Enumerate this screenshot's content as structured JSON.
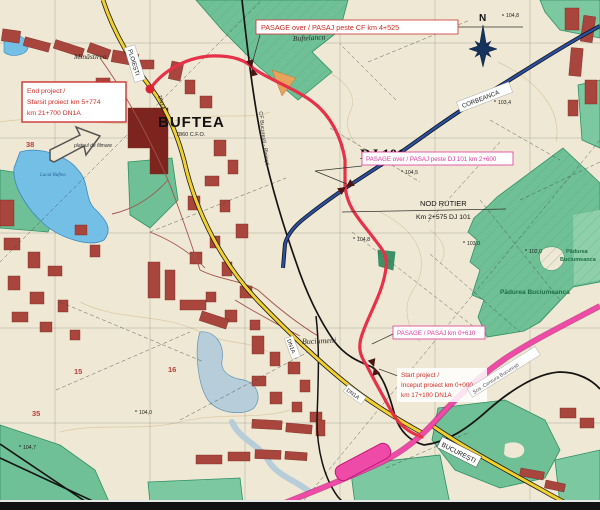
{
  "map": {
    "title_context": "Road project map - Buftea / DN1A / DJ 101",
    "labels": {
      "pasaj_cf": "PASAGE over / PASAJ peste CF km 4+525",
      "pasaj_dj101": "PASAGE over / PASAJ peste DJ 101 km 2+600",
      "pasaj_km0610": "PASAGE / PASAJ km 0+610",
      "nod_rutier": {
        "l1": "NOD RUTIER",
        "l2": "Km 2+575 DJ 101"
      },
      "end_project": {
        "l1": "End project /",
        "l2": "Sfarsit proiect km 5+774",
        "l3": "km 21+700 DN1A"
      },
      "start_project": {
        "l1": "Start project /",
        "l2": "Inceput proiect km 0+000",
        "l3": "km 17+100 DN1A"
      },
      "dj101": "DJ 101",
      "buftea": "BUFTEA",
      "buftea_sub": "7860 C.F.O.",
      "minastirea": "Mînăstirea",
      "bufteanca": "Buftelanca",
      "buciumeni": "Buciumeni",
      "corbeanca": "CORBEANCA",
      "bucuresti": "BUCUREȘTI",
      "ploiesti": "PLOIEȘTI",
      "dn1a_1": "DN1A",
      "dn1a_2": "DN1A",
      "dn1a_3": "DN1A",
      "cf_railway": "CF București - Ploiești",
      "centura": "Șos. Centura București",
      "padurea_right_l1": "Pădurea",
      "padurea_right_l2": "Buciumeanca",
      "padurea_main": "Pădurea Buciumeanca",
      "platoul": "platoul de filmare",
      "lacul": "Lacul Buftea",
      "compass_n": "N"
    },
    "elevations": [
      {
        "v": "104,8"
      },
      {
        "v": "103,4"
      },
      {
        "v": "104,5"
      },
      {
        "v": "104,8"
      },
      {
        "v": "103,0"
      },
      {
        "v": "102,0"
      },
      {
        "v": "104,7"
      },
      {
        "v": "104,0"
      }
    ],
    "grid_numbers": [
      "38",
      "15",
      "16",
      "35"
    ],
    "colors": {
      "paper": "#efe8d4",
      "project_route_red": "#e63148",
      "road_yellow": "#f2d12e",
      "road_pink": "#f04aa8",
      "road_blue": "#2c4f9e",
      "railway_black": "#141414",
      "forest_green": "#6fc096",
      "lake_blue": "#74bfe6",
      "urban_maroon": "#a8453c",
      "label_red": "#d32b24",
      "label_magenta": "#e0389a",
      "forest_label_green": "#1d6e46"
    }
  }
}
